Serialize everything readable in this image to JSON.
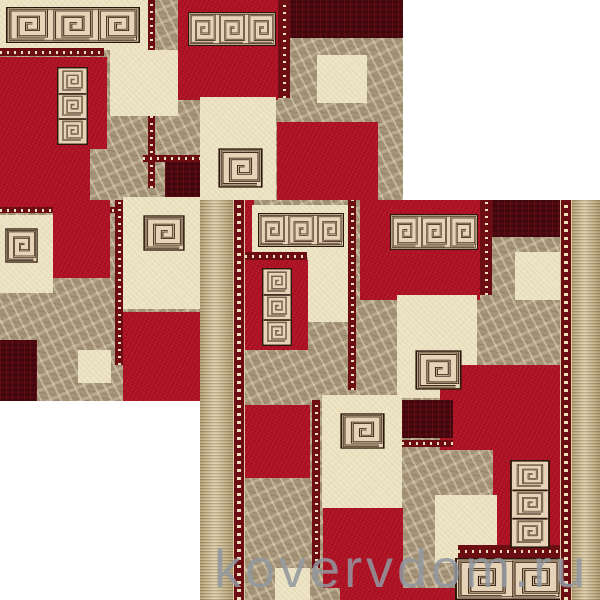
{
  "watermark": {
    "text": "kovervdom.ru",
    "color": "#9298a0"
  },
  "palette": {
    "page_bg": "#ffffff",
    "red": "#b11325",
    "maroon": "#4e0910",
    "cream": "#ece3c3",
    "marble": "#a59378",
    "tan_border": "#c7b58a",
    "ornament": "#6b0d12",
    "ornament_dot": "#ecdfbd",
    "motif_dark": "#2a1709",
    "motif_light": "#d9bf9e",
    "motif_bg": "#e7d3b8"
  },
  "carpets": [
    {
      "name": "carpet-sample-top-left",
      "x": 0,
      "y": 0,
      "w": 403,
      "h": 401,
      "blocks": [
        [
          0,
          0,
          148,
          50,
          "cream"
        ],
        [
          148,
          0,
          7,
          188,
          "dotv"
        ],
        [
          178,
          0,
          100,
          100,
          "red"
        ],
        [
          278,
          0,
          12,
          98,
          "dotv"
        ],
        [
          290,
          0,
          113,
          38,
          "maroon"
        ],
        [
          317,
          55,
          50,
          48,
          "cream"
        ],
        [
          277,
          122,
          101,
          125,
          "red"
        ],
        [
          0,
          48,
          104,
          8,
          "doth"
        ],
        [
          0,
          57,
          107,
          92,
          "red"
        ],
        [
          0,
          149,
          90,
          58,
          "red"
        ],
        [
          110,
          50,
          68,
          66,
          "cream"
        ],
        [
          143,
          155,
          70,
          7,
          "doth"
        ],
        [
          165,
          162,
          50,
          43,
          "maroon"
        ],
        [
          0,
          207,
          150,
          6,
          "doth"
        ],
        [
          0,
          215,
          53,
          78,
          "cream"
        ],
        [
          53,
          200,
          57,
          78,
          "red"
        ],
        [
          115,
          200,
          8,
          165,
          "dotv"
        ],
        [
          123,
          197,
          80,
          112,
          "cream"
        ],
        [
          123,
          312,
          80,
          89,
          "red"
        ],
        [
          0,
          340,
          37,
          61,
          "maroon"
        ],
        [
          78,
          350,
          33,
          33,
          "cream"
        ],
        [
          175,
          383,
          28,
          18,
          "red"
        ],
        [
          200,
          97,
          76,
          103,
          "cream"
        ]
      ],
      "motifs": [
        [
          6,
          7,
          134,
          36,
          "band3"
        ],
        [
          188,
          12,
          88,
          34,
          "band3"
        ],
        [
          57,
          67,
          31,
          78,
          "col3"
        ],
        [
          5,
          228,
          33,
          35,
          "spiral"
        ],
        [
          143,
          215,
          42,
          36,
          "spiral"
        ],
        [
          218,
          148,
          45,
          40,
          "spiral"
        ]
      ],
      "borders": []
    },
    {
      "name": "carpet-sample-bottom-right",
      "x": 200,
      "y": 200,
      "w": 400,
      "h": 400,
      "blocks": [
        [
          40,
          0,
          14,
          57,
          "red"
        ],
        [
          52,
          5,
          96,
          52,
          "cream"
        ],
        [
          45,
          52,
          62,
          8,
          "doth"
        ],
        [
          44,
          60,
          64,
          90,
          "red"
        ],
        [
          108,
          52,
          40,
          70,
          "cream"
        ],
        [
          148,
          0,
          8,
          190,
          "dotv"
        ],
        [
          160,
          0,
          120,
          100,
          "red"
        ],
        [
          280,
          0,
          12,
          95,
          "dotv"
        ],
        [
          292,
          0,
          68,
          37,
          "maroon"
        ],
        [
          315,
          52,
          45,
          48,
          "cream"
        ],
        [
          197,
          95,
          80,
          103,
          "cream"
        ],
        [
          240,
          165,
          120,
          85,
          "red"
        ],
        [
          202,
          200,
          51,
          38,
          "maroon"
        ],
        [
          202,
          240,
          51,
          7,
          "doth"
        ],
        [
          40,
          205,
          70,
          73,
          "red"
        ],
        [
          112,
          200,
          8,
          168,
          "dotv"
        ],
        [
          122,
          195,
          80,
          113,
          "cream"
        ],
        [
          123,
          308,
          80,
          80,
          "red"
        ],
        [
          293,
          248,
          70,
          100,
          "red"
        ],
        [
          235,
          295,
          62,
          68,
          "cream"
        ],
        [
          258,
          345,
          104,
          13,
          "doth"
        ],
        [
          75,
          368,
          35,
          32,
          "cream"
        ],
        [
          140,
          388,
          127,
          12,
          "red"
        ]
      ],
      "motifs": [
        [
          58,
          13,
          86,
          34,
          "band3"
        ],
        [
          62,
          68,
          30,
          78,
          "col3"
        ],
        [
          190,
          14,
          88,
          36,
          "band3"
        ],
        [
          215,
          150,
          47,
          40,
          "spiral"
        ],
        [
          140,
          213,
          45,
          36,
          "spiral"
        ],
        [
          310,
          260,
          40,
          88,
          "col3"
        ],
        [
          255,
          358,
          108,
          42,
          "band2"
        ]
      ],
      "borders": [
        [
          0,
          0,
          33,
          400,
          "tan"
        ],
        [
          33,
          0,
          12,
          400,
          "orn"
        ],
        [
          360,
          0,
          12,
          400,
          "orn"
        ],
        [
          372,
          0,
          28,
          400,
          "tan"
        ]
      ]
    }
  ]
}
